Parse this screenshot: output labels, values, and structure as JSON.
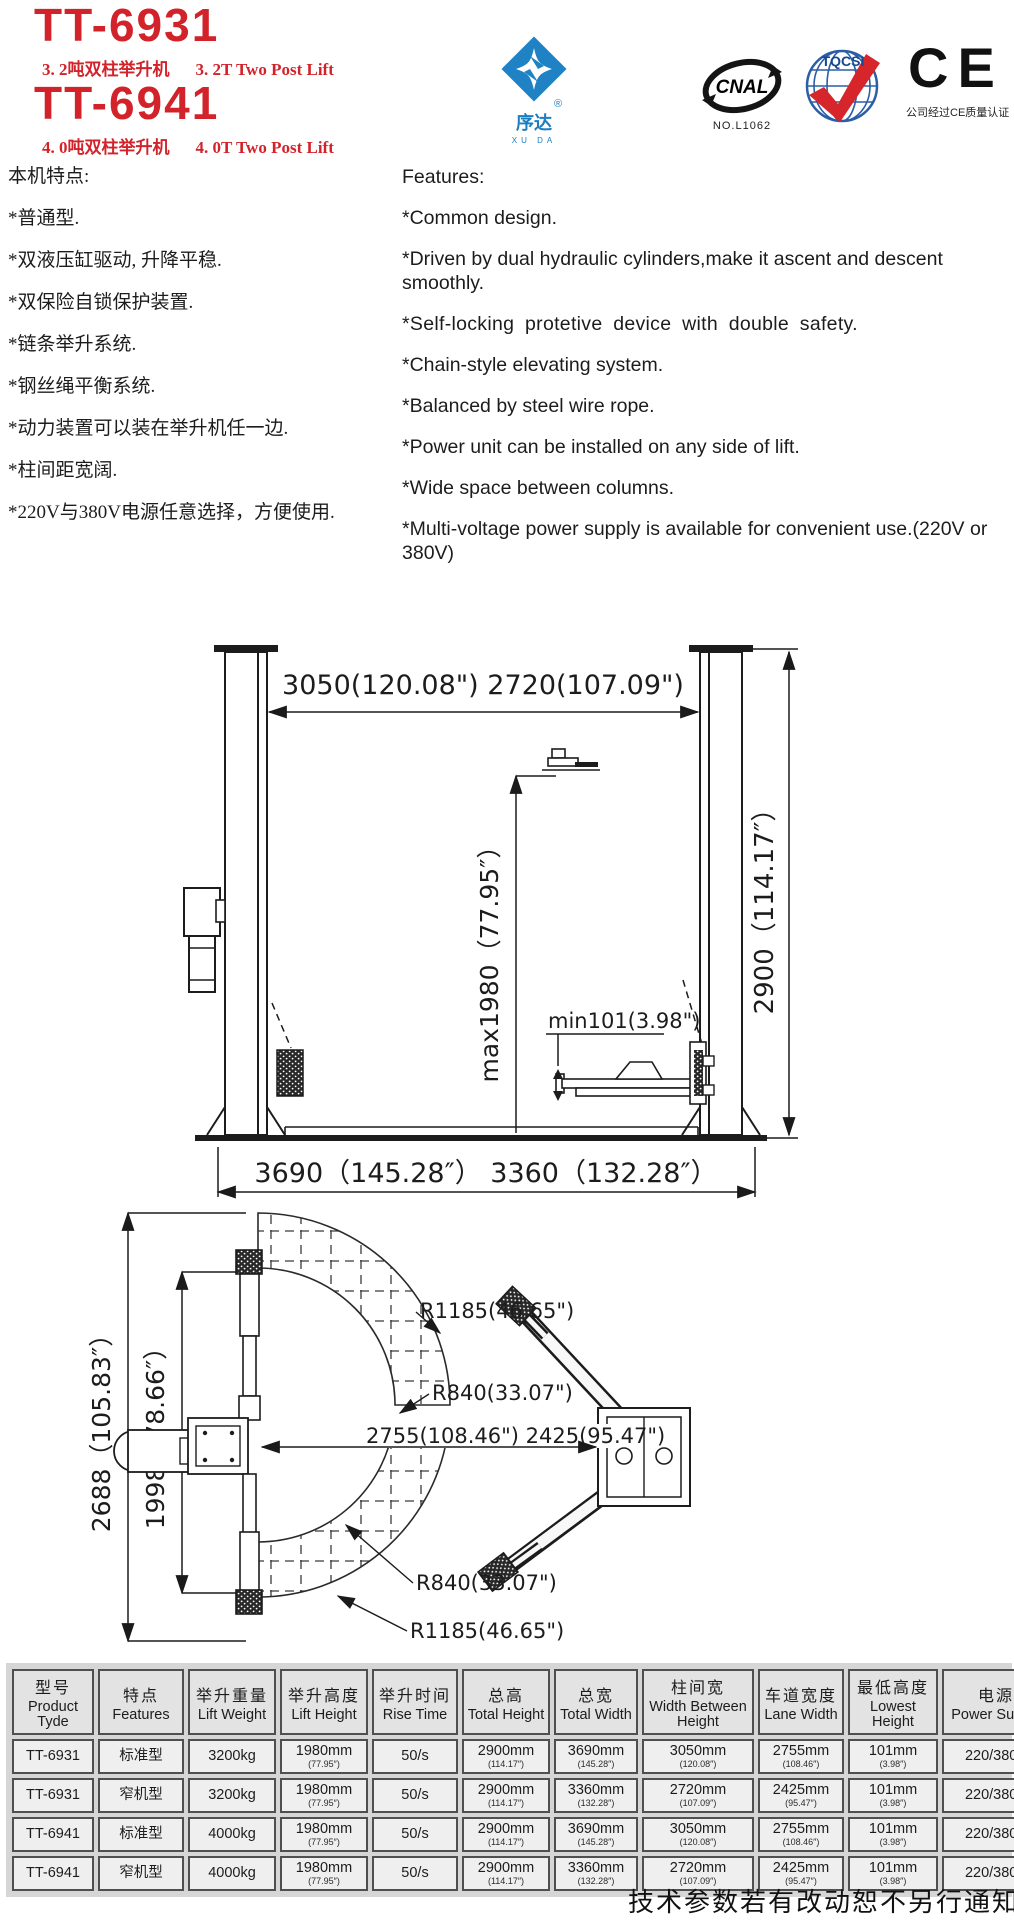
{
  "header": {
    "model1": "TT-6931",
    "model1_sub_cn": "3. 2吨双柱举升机",
    "model1_sub_en": "3. 2T  Two Post Lift",
    "model2": "TT-6941",
    "model2_sub_cn": "4. 0吨双柱举升机",
    "model2_sub_en": "4. 0T  Two Post Lift",
    "xuda": {
      "name": "序达",
      "reg": "®",
      "sub": "XU DA"
    },
    "cnal": {
      "text": "CNAL",
      "no": "NO.L1062"
    },
    "tqcsi": {
      "text": "TQCSI"
    },
    "ce": {
      "text": "CE",
      "caption": "公司经过CE质量认证"
    }
  },
  "features_cn": {
    "title": "本机特点:",
    "items": [
      "*普通型.",
      "*双液压缸驱动, 升降平稳.",
      "*双保险自锁保护装置.",
      "*链条举升系统.",
      "*钢丝绳平衡系统.",
      "*动力装置可以装在举升机任一边.",
      "*柱间距宽阔.",
      "*220V与380V电源任意选择，方便使用."
    ]
  },
  "features_en": {
    "title": "Features:",
    "items": [
      "*Common design.",
      "*Driven by dual hydraulic cylinders,make it ascent and descent smoothly.",
      "*Self-locking protetive device with double safety.",
      "*Chain-style elevating system.",
      "*Balanced by steel wire rope.",
      "*Power unit can be installed on any side of lift.",
      "*Wide space between columns.",
      "*Multi-voltage power supply is available for convenient use.(220V or 380V)"
    ]
  },
  "front_view": {
    "dim_width_top": "3050(120.08\") 2720(107.09\")",
    "dim_max_height": "max1980（77.95″）",
    "dim_min_height": "min101(3.98\")",
    "dim_total_height": "2900（114.17″）",
    "dim_width_bottom": "3690（145.28″） 3360（132.28″）"
  },
  "top_view": {
    "dim_length_outer": "2688（105.83″）",
    "dim_length_inner": "1998（78.66″）",
    "r1185_upper": "R1185(46.65\")",
    "r840_upper": "R840(33.07\")",
    "dim_width_mid": "2755(108.46\") 2425(95.47\")",
    "r840_lower": "R840(33.07\")",
    "r1185_lower": "R1185(46.65\")"
  },
  "spec_table": {
    "headers": [
      {
        "cn": "型号",
        "en": "Product Tyde"
      },
      {
        "cn": "特点",
        "en": "Features"
      },
      {
        "cn": "举升重量",
        "en": "Lift Weight"
      },
      {
        "cn": "举升高度",
        "en": "Lift Height"
      },
      {
        "cn": "举升时间",
        "en": "Rise Time"
      },
      {
        "cn": "总高",
        "en": "Total Height"
      },
      {
        "cn": "总宽",
        "en": "Total Width"
      },
      {
        "cn": "柱间宽",
        "en": "Width Between Height"
      },
      {
        "cn": "车道宽度",
        "en": "Lane Width"
      },
      {
        "cn": "最低高度",
        "en": "Lowest Height"
      },
      {
        "cn": "电源",
        "en": "Power Supply"
      }
    ],
    "rows": [
      {
        "cells": [
          {
            "m": "TT-6931"
          },
          {
            "m": "标准型"
          },
          {
            "m": "3200kg"
          },
          {
            "m": "1980mm",
            "s": "(77.95″)"
          },
          {
            "m": "50/s"
          },
          {
            "m": "2900mm",
            "s": "(114.17″)"
          },
          {
            "m": "3690mm",
            "s": "(145.28″)"
          },
          {
            "m": "3050mm",
            "s": "(120.08″)"
          },
          {
            "m": "2755mm",
            "s": "(108.46″)"
          },
          {
            "m": "101mm",
            "s": "(3.98″)"
          },
          {
            "m": "220/380V"
          }
        ]
      },
      {
        "cells": [
          {
            "m": "TT-6931"
          },
          {
            "m": "窄机型"
          },
          {
            "m": "3200kg"
          },
          {
            "m": "1980mm",
            "s": "(77.95″)"
          },
          {
            "m": "50/s"
          },
          {
            "m": "2900mm",
            "s": "(114.17″)"
          },
          {
            "m": "3360mm",
            "s": "(132.28″)"
          },
          {
            "m": "2720mm",
            "s": "(107.09″)"
          },
          {
            "m": "2425mm",
            "s": "(95.47″)"
          },
          {
            "m": "101mm",
            "s": "(3.98″)"
          },
          {
            "m": "220/380V"
          }
        ]
      },
      {
        "cells": [
          {
            "m": "TT-6941"
          },
          {
            "m": "标准型"
          },
          {
            "m": "4000kg"
          },
          {
            "m": "1980mm",
            "s": "(77.95″)"
          },
          {
            "m": "50/s"
          },
          {
            "m": "2900mm",
            "s": "(114.17″)"
          },
          {
            "m": "3690mm",
            "s": "(145.28″)"
          },
          {
            "m": "3050mm",
            "s": "(120.08″)"
          },
          {
            "m": "2755mm",
            "s": "(108.46″)"
          },
          {
            "m": "101mm",
            "s": "(3.98″)"
          },
          {
            "m": "220/380V"
          }
        ]
      },
      {
        "cells": [
          {
            "m": "TT-6941"
          },
          {
            "m": "窄机型"
          },
          {
            "m": "4000kg"
          },
          {
            "m": "1980mm",
            "s": "(77.95″)"
          },
          {
            "m": "50/s"
          },
          {
            "m": "2900mm",
            "s": "(114.17″)"
          },
          {
            "m": "3360mm",
            "s": "(132.28″)"
          },
          {
            "m": "2720mm",
            "s": "(107.09″)"
          },
          {
            "m": "2425mm",
            "s": "(95.47″)"
          },
          {
            "m": "101mm",
            "s": "(3.98″)"
          },
          {
            "m": "220/380V"
          }
        ]
      }
    ]
  },
  "footer": {
    "note": "技术参数若有改动恕不另行通知"
  },
  "colors": {
    "brand_red": "#d2232a",
    "logo_blue": "#1e82c4",
    "tqcsi_blue": "#2b5ea7",
    "check_red": "#d6252b"
  }
}
